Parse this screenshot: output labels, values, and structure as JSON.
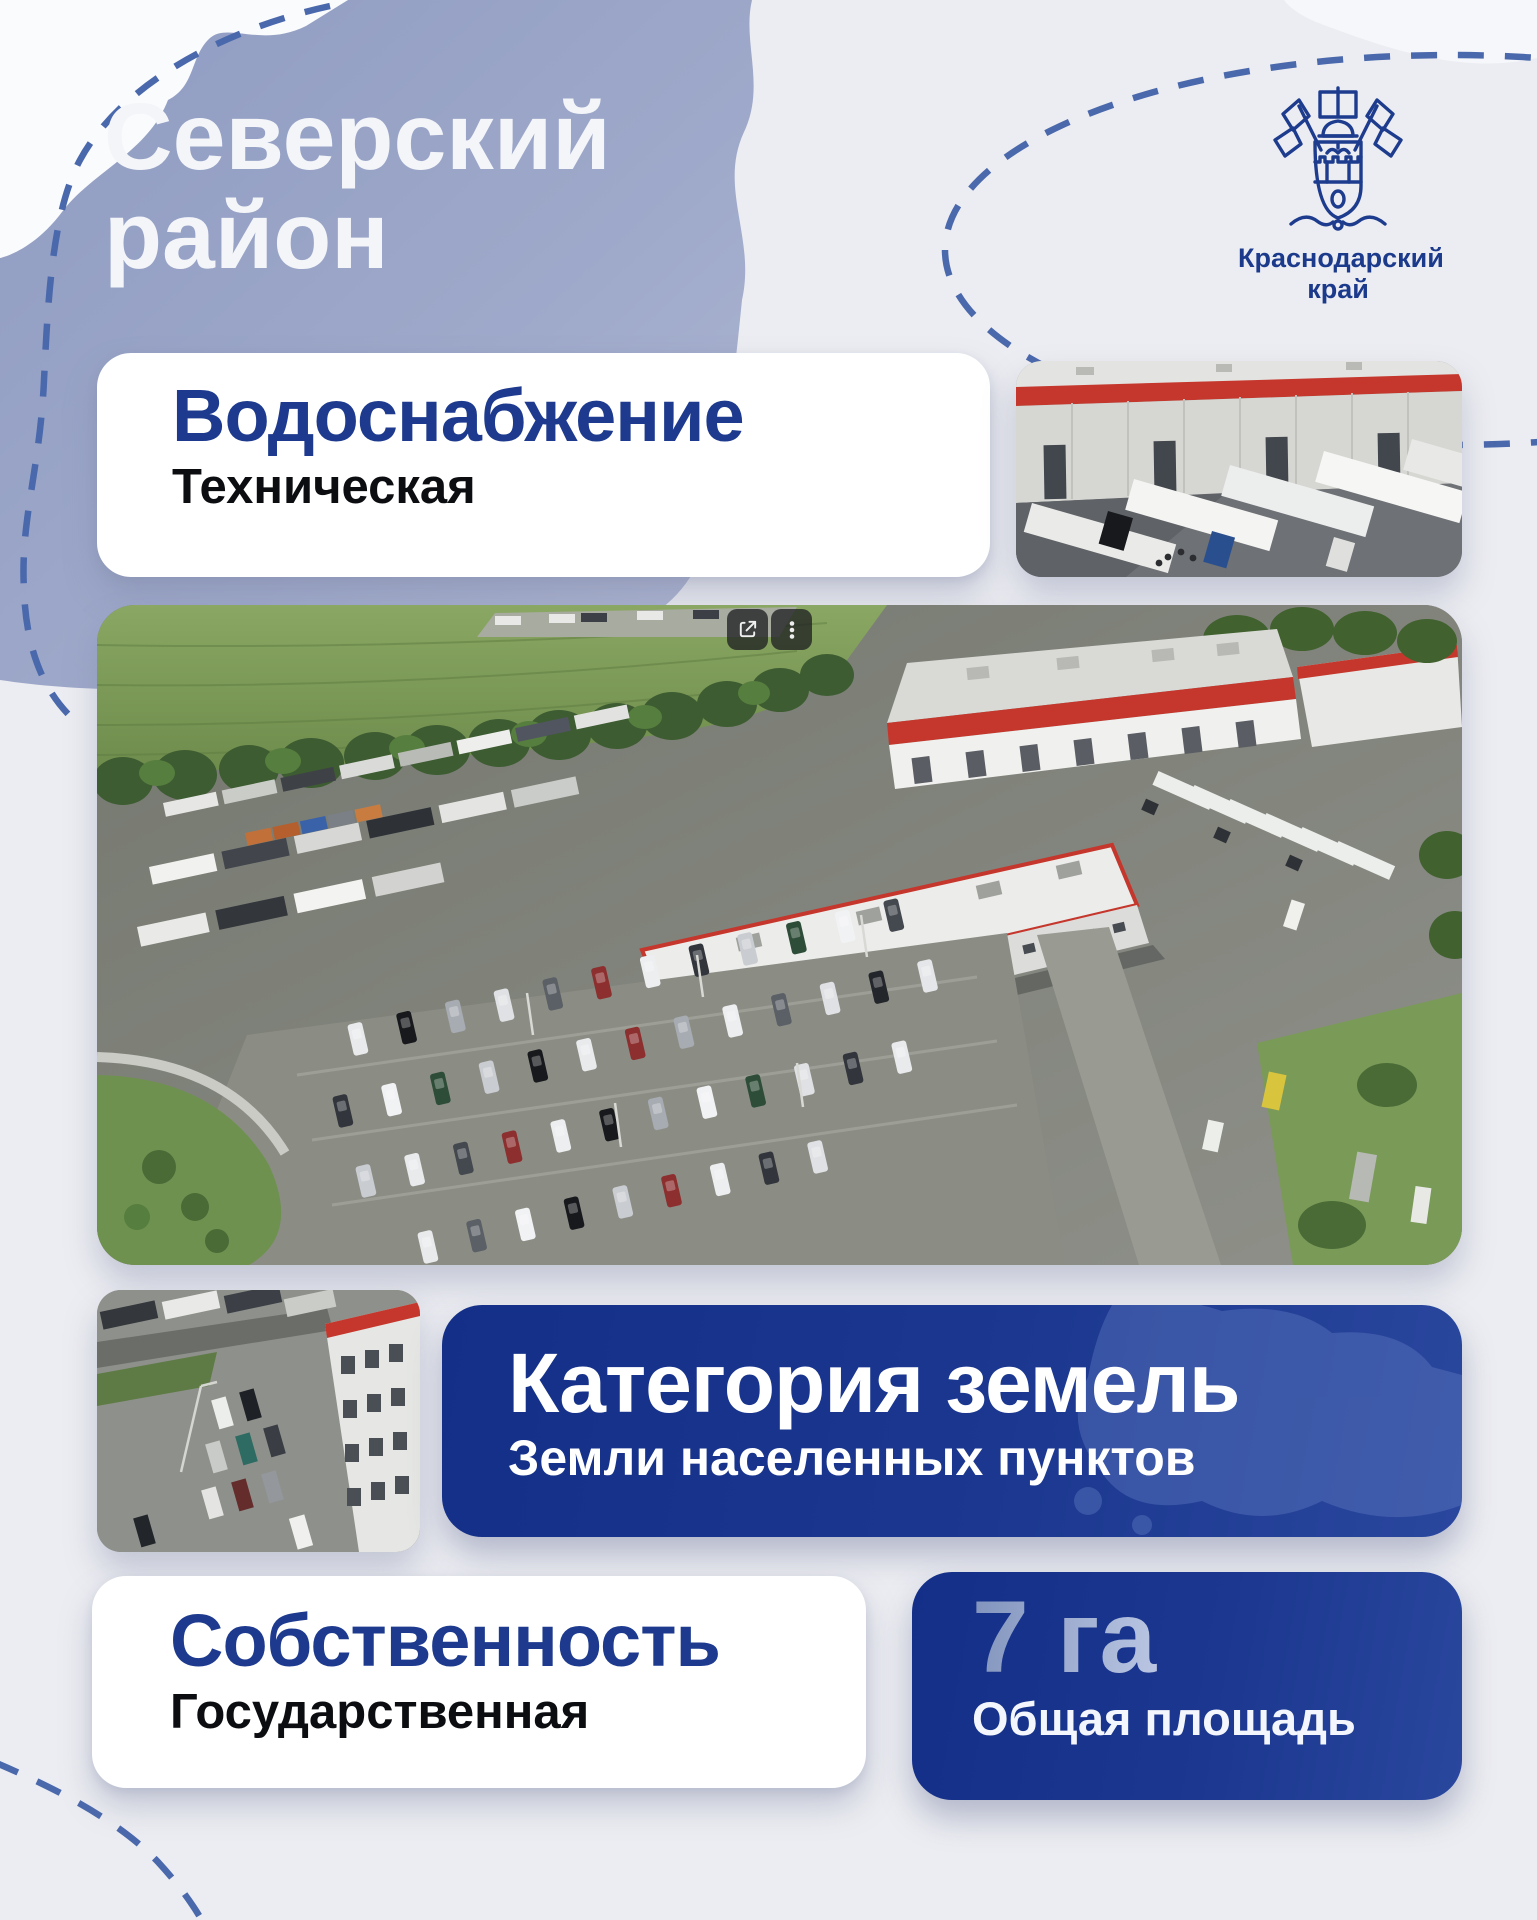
{
  "header": {
    "district_line1": "Северский",
    "district_line2": "район",
    "region_line1": "Краснодарский",
    "region_line2": "край"
  },
  "cards": {
    "water_supply": {
      "title": "Водоснабжение",
      "value": "Техническая"
    },
    "land_category": {
      "title": "Категория земель",
      "value": "Земли населенных пунктов"
    },
    "ownership": {
      "title": "Собственность",
      "value": "Государственная"
    },
    "total_area": {
      "value": "7 га",
      "label": "Общая площадь"
    }
  },
  "photo_viewer": {
    "share_icon": "open-in-new",
    "menu_icon": "kebab-vertical-menu"
  },
  "colors": {
    "accent_blue": "#1d3a8e",
    "card_blue": "#1b378f",
    "dashed_line": "#4a68ac",
    "building_red": "#c5372c",
    "map_fill": "#97a3c7"
  }
}
